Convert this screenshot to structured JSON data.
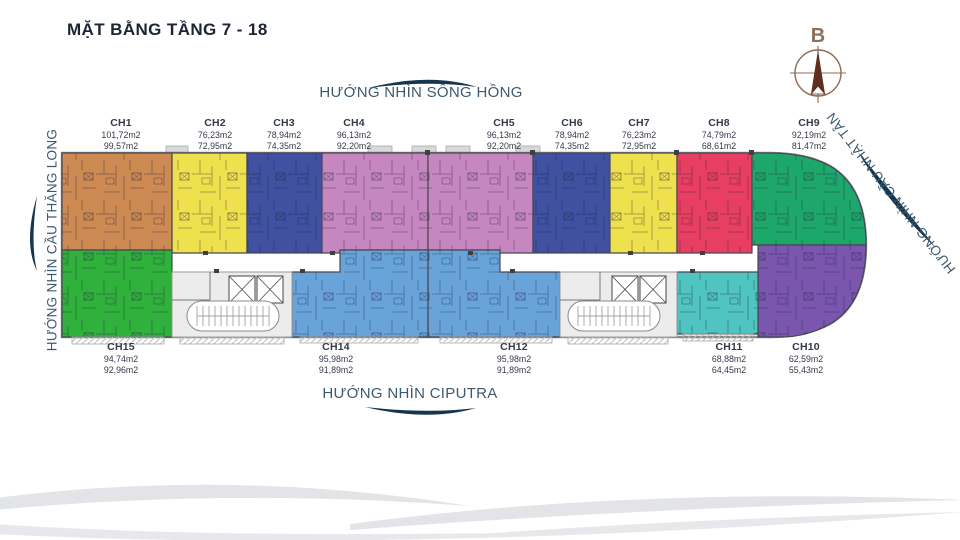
{
  "title": "MẶT BẰNG TẦNG 7 - 18",
  "compass": {
    "north_label": "B"
  },
  "directions": {
    "top": "HƯỚNG NHÌN SÔNG HỒNG",
    "bottom": "HƯỚNG NHÌN CIPUTRA",
    "left": "HƯỚNG NHÌN CẦU THĂNG LONG",
    "right": "HƯỚNG NHÌN CẦU NHẬT TÂN"
  },
  "units": [
    {
      "id": "CH1",
      "areas": [
        "101,72m2",
        "99,57m2"
      ],
      "color": "#cd8a52"
    },
    {
      "id": "CH2",
      "areas": [
        "76,23m2",
        "72,95m2"
      ],
      "color": "#efe14d"
    },
    {
      "id": "CH3",
      "areas": [
        "78,94m2",
        "74,35m2"
      ],
      "color": "#3f51a0"
    },
    {
      "id": "CH4",
      "areas": [
        "96,13m2",
        "92,20m2"
      ],
      "color": "#c687c0"
    },
    {
      "id": "CH5",
      "areas": [
        "96,13m2",
        "92,20m2"
      ],
      "color": "#c687c0"
    },
    {
      "id": "CH6",
      "areas": [
        "78,94m2",
        "74,35m2"
      ],
      "color": "#3f51a0"
    },
    {
      "id": "CH7",
      "areas": [
        "76,23m2",
        "72,95m2"
      ],
      "color": "#efe14d"
    },
    {
      "id": "CH8",
      "areas": [
        "74,79m2",
        "68,61m2"
      ],
      "color": "#e83e62"
    },
    {
      "id": "CH9",
      "areas": [
        "92,19m2",
        "81,47m2"
      ],
      "color": "#1ea76a"
    },
    {
      "id": "CH10",
      "areas": [
        "62,59m2",
        "55,43m2"
      ],
      "color": "#7a56ae"
    },
    {
      "id": "CH11",
      "areas": [
        "68,88m2",
        "64,45m2"
      ],
      "color": "#4fc4c0"
    },
    {
      "id": "CH12",
      "areas": [
        "95,98m2",
        "91,89m2"
      ],
      "color": "#68a4d9"
    },
    {
      "id": "CH14",
      "areas": [
        "95,98m2",
        "91,89m2"
      ],
      "color": "#68a4d9"
    },
    {
      "id": "CH15",
      "areas": [
        "94,74m2",
        "92,96m2"
      ],
      "color": "#2fb13c"
    }
  ],
  "colors": {
    "accent_navy": "#16364f",
    "direction_text": "#3d5a6e",
    "label_text": "#333a4b",
    "compass_brown": "#8b6f5c",
    "wave_gray": "#e2e4e8"
  }
}
